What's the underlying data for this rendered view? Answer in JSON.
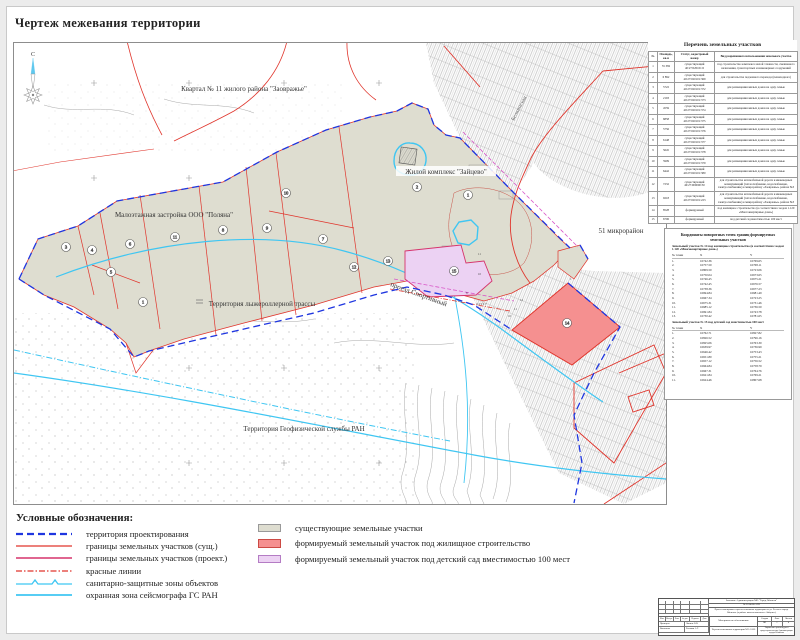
{
  "page": {
    "title": "Чертеж межевания территории"
  },
  "colors": {
    "design_boundary_blue": "#1f36e0",
    "existing_boundary_red": "#e0352c",
    "project_boundary_crimson": "#d6336c",
    "red_lines": "#e0352c",
    "sanitary_cyan": "#3fc6f2",
    "existing_plot_beige": "#deddd0",
    "housing_plot_salmon": "#f59090",
    "kindergarten_plot_lavender": "#ecd2f3"
  },
  "map": {
    "north_label": "С",
    "labels": {
      "kvartal": "Квартал № 11 жилого района \"Заовражье\"",
      "polyana": "Малоэтажная застройка ООО \"Поляна\"",
      "zaitsevo": "Жилой комплекс \"Зайцево\"",
      "lyzhe": "Территория лыжероллерной трассы",
      "geofiz": "Территория Геофизической службы РАН",
      "mkr51": "51 микрорайон",
      "belkinskaya": "Белкинская",
      "sportivny": "проезд Спортивный"
    },
    "circles": [
      {
        "n": "3"
      },
      {
        "n": "4"
      },
      {
        "n": "5"
      },
      {
        "n": "6"
      },
      {
        "n": "11"
      },
      {
        "n": "8"
      },
      {
        "n": "9"
      },
      {
        "n": "10"
      },
      {
        "n": "7"
      },
      {
        "n": "12"
      },
      {
        "n": "1"
      },
      {
        "n": "2"
      },
      {
        "n": "1"
      },
      {
        "n": "13"
      },
      {
        "n": "15"
      },
      {
        "n": "14"
      }
    ],
    "point_labels": [
      "11",
      "10",
      "12",
      "11",
      "10",
      "1",
      "8",
      "3  4  5  6  7"
    ]
  },
  "tables": {
    "plots": {
      "title": "Перечень земельных участков",
      "headers": [
        "№",
        "Площадь, кв.м",
        "Статус, кадастровый номер",
        "Вид разрешенного использования земельного участка"
      ],
      "rows": [
        {
          "n": "1",
          "area": "55 382",
          "status": "существующий",
          "cad": "40:27:020101:6",
          "usage": "под строительство комплекса малой этажности, смешанного назначения, транспортных и инженерных сооружений"
        },
        {
          "n": "2",
          "area": "6 892",
          "status": "существующий",
          "cad": "40:27:020101:369",
          "usage": "для строительства подземного перехода (пешеходного)"
        },
        {
          "n": "3",
          "area": "5722",
          "status": "существующий",
          "cad": "40:27:020101:372",
          "usage": "для размещения жилых домов на одну семью"
        },
        {
          "n": "4",
          "area": "2193",
          "status": "существующий",
          "cad": "40:27:020101:373",
          "usage": "для размещения жилых домов на одну семью"
        },
        {
          "n": "5",
          "area": "4559",
          "status": "существующий",
          "cad": "40:27:020101:374",
          "usage": "для размещения жилых домов на одну семью"
        },
        {
          "n": "6",
          "area": "6858",
          "status": "существующий",
          "cad": "40:27:020101:375",
          "usage": "для размещения жилых домов на одну семью"
        },
        {
          "n": "7",
          "area": "5756",
          "status": "существующий",
          "cad": "40:27:020101:376",
          "usage": "для размещения жилых домов на одну семью"
        },
        {
          "n": "8",
          "area": "6148",
          "status": "существующий",
          "cad": "40:27:020101:377",
          "usage": "для размещения жилых домов на одну семью"
        },
        {
          "n": "9",
          "area": "5645",
          "status": "существующий",
          "cad": "40:27:020101:378",
          "usage": "для размещения жилых домов на одну семью"
        },
        {
          "n": "10",
          "area": "5909",
          "status": "существующий",
          "cad": "40:27:020101:379",
          "usage": "для размещения жилых домов на одну семью"
        },
        {
          "n": "11",
          "area": "6442",
          "status": "существующий",
          "cad": "40:27:020101:380",
          "usage": "для размещения жилых домов на одну семью"
        },
        {
          "n": "12",
          "area": "7232",
          "status": "существующий",
          "cad": "40:27:000000:30",
          "usage": "для строительства автомобильной дороги и инженерных коммуникаций (теплоснабжение, водоснабжение, электроснабжение) к микрорайону «Заовражье» района №3"
        },
        {
          "n": "13",
          "area": "9218",
          "status": "существующий",
          "cad": "40:27:020101:223",
          "usage": "для строительства автомобильной дороги и инженерных коммуникаций (теплоснабжение, водоснабжение, электроснабжение) к микрорайону «Заовражье» района №3"
        },
        {
          "n": "14",
          "area": "8528",
          "status": "формируемый",
          "cad": "",
          "usage": "под жилищное строительство (в соответствии с кодом 1.120 «Многоквартирные дома»)"
        },
        {
          "n": "15",
          "area": "6706",
          "status": "формируемый",
          "cad": "",
          "usage": "под детский сад вместимостью 100 мест"
        }
      ]
    },
    "coords": {
      "title": "Координаты поворотных точек границ формируемых земельных участков",
      "headers": {
        "n": "№ точки",
        "x": "X",
        "y": "Y"
      },
      "block14": {
        "title": "Земельный участок № 14 под жилищное строительство (в соответствии с кодом 1.120 «Многоквартирные дома»)",
        "rows": [
          {
            "n": "1.",
            "x": "16742.36",
            "y": "16769.65"
          },
          {
            "n": "2.",
            "x": "16757.50",
            "y": "16768.11"
          },
          {
            "n": "3.",
            "x": "16809.50",
            "y": "16723.06"
          },
          {
            "n": "4.",
            "x": "16750.04",
            "y": "16673.65"
          },
          {
            "n": "5.",
            "x": "16746.45",
            "y": "16675.21"
          },
          {
            "n": "6.",
            "x": "16742.45",
            "y": "16676.57"
          },
          {
            "n": "7.",
            "x": "16738.36",
            "y": "16677.23"
          },
          {
            "n": "8.",
            "x": "16694.84",
            "y": "16681.49"
          },
          {
            "n": "9.",
            "x": "16667.34",
            "y": "16723.25"
          },
          {
            "n": "10.",
            "x": "16675.31",
            "y": "16731.46"
          },
          {
            "n": "11.",
            "x": "16685.12",
            "y": "16736.50"
          },
          {
            "n": "12.",
            "x": "16691.84",
            "y": "16743.78"
          },
          {
            "n": "13.",
            "x": "16730.42",
            "y": "16781.65"
          }
        ]
      },
      "block15": {
        "title": "Земельный участок № 15 под детский сад вместимостью 100 мест",
        "rows": [
          {
            "n": "1.",
            "x": "16762.71",
            "y": "16827.82"
          },
          {
            "n": "2.",
            "x": "16826.52",
            "y": "16796.16"
          },
          {
            "n": "3.",
            "x": "16825.06",
            "y": "16763.30"
          },
          {
            "n": "4.",
            "x": "16639.97",
            "y": "16736.99"
          },
          {
            "n": "5.",
            "x": "16646.42",
            "y": "16753.43"
          },
          {
            "n": "6.",
            "x": "16651.80",
            "y": "16755.21"
          },
          {
            "n": "7.",
            "x": "16657.12",
            "y": "16756.52"
          },
          {
            "n": "8.",
            "x": "16664.84",
            "y": "16758.79"
          },
          {
            "n": "9.",
            "x": "16667.31",
            "y": "16764.76"
          },
          {
            "n": "10.",
            "x": "16621.84",
            "y": "16769.21"
          },
          {
            "n": "11.",
            "x": "16624.46",
            "y": "16807.68"
          }
        ]
      }
    }
  },
  "legend": {
    "heading": "Условные обозначения:",
    "lines": [
      {
        "label": "территория проектирования"
      },
      {
        "label": "границы земельных участков (сущ.)"
      },
      {
        "label": "границы земельных участков (проект.)"
      },
      {
        "label": "красные линии"
      },
      {
        "label": "санитарно-защитные зоны объектов"
      },
      {
        "label": "охранная зона сейсмографа ГС РАН"
      }
    ],
    "areas": [
      {
        "label": "существующие земельные участки"
      },
      {
        "label": "формируемый земельный участок под жилищное строительство"
      },
      {
        "label": "формируемый земельный участок под детский сад вместимостью 100 мест"
      }
    ]
  },
  "stamp": {
    "customer": "Заказчик: Администрация МО \"Город Обнинск\"",
    "doc_no": "№ 2014-06-АПЗ",
    "project": "Проект планировки и проект межевания территории по ул. Лесная в городе Обнинске (в районе жилого комплекса «Зайцево»)",
    "sig_cols": [
      "Изм.",
      "Кол.уч.",
      "Лист",
      "№ док.",
      "Подпись",
      "Дата"
    ],
    "checked_role": "Проверил",
    "checked_name": "Ляпина О.В.",
    "made_role": "Выполнил",
    "made_name": "Рыськов А.Г.",
    "materials": "Материалы по обоснованию",
    "doc_title": "Чертеж межевания территории М 1:1000",
    "stage_label": "Стадия",
    "sheet_label": "Лист",
    "sheets_label": "Листов",
    "stage": "ПП",
    "sheet": "1",
    "sheets": "4",
    "org": "Управление архитектуры и градостроительства Администрации города Обнинска"
  }
}
